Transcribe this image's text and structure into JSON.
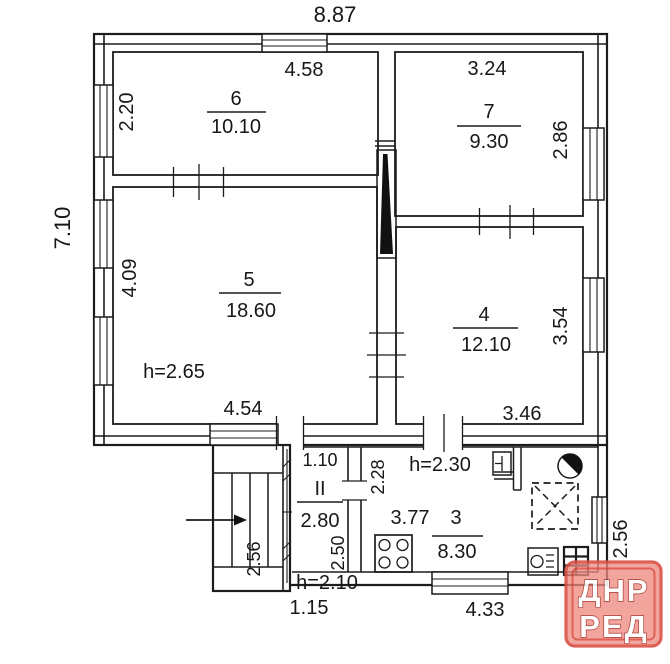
{
  "outer": {
    "top_width": "8.87",
    "left_height": "7.10"
  },
  "rooms": {
    "r6": {
      "number": "6",
      "area": "10.10",
      "width_top": "4.58",
      "height_left": "2.20"
    },
    "r7": {
      "number": "7",
      "area": "9.30",
      "width_top": "3.24",
      "height_right": "2.86"
    },
    "r5": {
      "number": "5",
      "area": "18.60",
      "height_left": "4.09",
      "width_bottom": "4.54",
      "ceiling_height": "h=2.65"
    },
    "r4": {
      "number": "4",
      "area": "12.10",
      "height_right": "3.54",
      "width_bottom": "3.46"
    },
    "r3": {
      "number": "3",
      "area": "8.30",
      "width": "3.77",
      "height_left": "2.28",
      "ceiling_height": "h=2.30"
    },
    "vestibule": {
      "number": "II",
      "area": "2.80",
      "width_top": "1.10",
      "height_right": "2.50",
      "ceiling_height": "h=2.10"
    },
    "porch": {
      "height_right": "2.56"
    }
  },
  "annex": {
    "height_right": "2.56",
    "width_bottom_left": "1.15",
    "width_bottom_right": "4.33"
  },
  "watermark": {
    "line1": "ДНР",
    "line2": "РЕД",
    "fill": "#ef8a7e",
    "border": "#db5045",
    "text_color": "#ffffff",
    "text_outline": "#9c241c"
  },
  "colors": {
    "line": "#1c1c1c",
    "ink": "#171717",
    "paper": "#ffffff"
  },
  "icons": {
    "flue": "flue-duct-icon",
    "entrance_arrow": "entrance-arrow-icon",
    "stairs": "staircase",
    "stove": "gas-stove-icon",
    "water_heater": "water-heater-icon",
    "sink": "sink-icon",
    "shower": "shower-tray-icon",
    "gas_boiler": "gas-boiler-icon",
    "vent_grille": "vent-grille-icon",
    "windows": "window-icon",
    "doors": "door-opening"
  }
}
